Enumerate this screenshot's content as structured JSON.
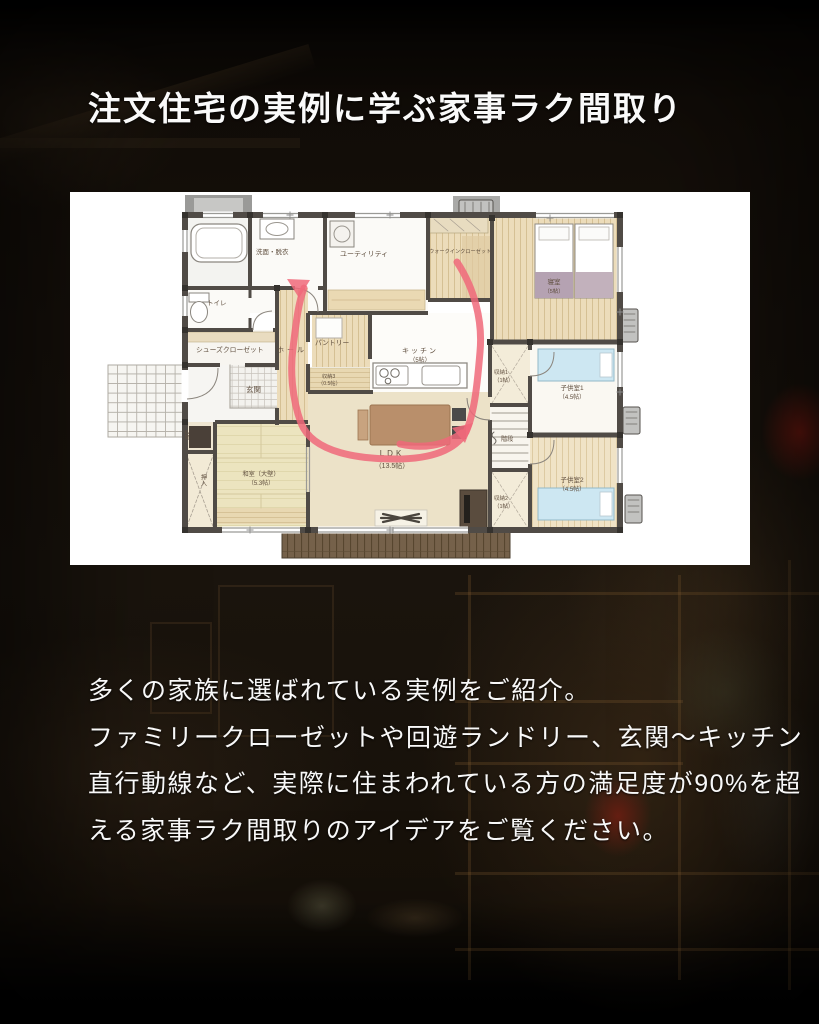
{
  "title": "注文住宅の実例に学ぶ家事ラク間取り",
  "description": {
    "lines": [
      "多くの家族に選ばれている実例をご紹介。",
      "ファミリークローゼットや回遊ランドリー、玄関〜キッチン",
      "直行動線など、実際に住まわれている方の満足度が90%を超",
      "える家事ラク間取りのアイデアをご覧ください。"
    ]
  },
  "floor_plan": {
    "panel_bg": "#ffffff",
    "arrow_color": "#f0697a",
    "wall_color": "#504b46",
    "rooms": {
      "senmen": {
        "label": "洗面・脱衣"
      },
      "utility": {
        "label": "ユーティリティ"
      },
      "wic": {
        "label": "ウォークインクローゼット"
      },
      "bedroom": {
        "label": "寝室",
        "size": "（5帖）"
      },
      "toilet": {
        "label": "トイレ"
      },
      "shoes": {
        "label": "シューズクローゼット"
      },
      "genkan": {
        "label": "玄関"
      },
      "hall": {
        "label": "ホール"
      },
      "pantry": {
        "label": "パントリー"
      },
      "storage3": {
        "label": "収納3",
        "size": "（0.5帖）"
      },
      "kitchen": {
        "label": "キッチン",
        "size": "（5帖）"
      },
      "ldk": {
        "label": "LDK",
        "size": "（13.5帖）"
      },
      "washitsu": {
        "label": "和室（大壁）",
        "size": "（5.3帖）"
      },
      "oshiire": {
        "label": "押入"
      },
      "butsuma": {
        "label": "仏間"
      },
      "storage1": {
        "label": "収納1",
        "size": "（1帖）"
      },
      "stairs": {
        "label": "階段"
      },
      "storage2": {
        "label": "収納2",
        "size": "（1帖）"
      },
      "kids1": {
        "label": "子供室1",
        "size": "（4.5帖）"
      },
      "kids2": {
        "label": "子供室2",
        "size": "（4.5帖）"
      }
    }
  }
}
